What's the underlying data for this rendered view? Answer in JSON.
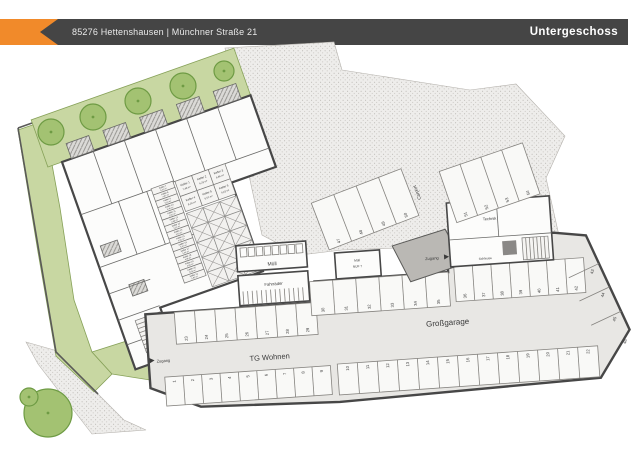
{
  "header": {
    "address": "85276 Hettenshausen | Münchner Straße 21",
    "title": "Untergeschoss"
  },
  "colors": {
    "bar": "#454545",
    "accent": "#f18a2a",
    "wall": "#474747",
    "green": "#c8d7a2",
    "tree": "#a3c272",
    "garage": "#e8e7e4"
  },
  "labels": {
    "tg_wohnen": "TG Wohnen",
    "grossgarage": "Großgarage",
    "muell": "Müll",
    "fahrraeder": "Fahrräder",
    "carport": "Carport",
    "technik": "Technik",
    "schleuse": "Schleuse",
    "zugang_tg": "Zugang",
    "zugang_technik": "Zugang",
    "muell_nuf_line1": "Müll",
    "muell_nuf_line2": "NUF 7"
  },
  "keller_top": [
    {
      "name": "Keller 1",
      "area": "7,49 m²"
    },
    {
      "name": "Keller 2",
      "area": "6,32 m²"
    },
    {
      "name": "Keller 3",
      "area": "6,86 m²"
    },
    {
      "name": "Keller 4",
      "area": "8,03 m²"
    },
    {
      "name": "Keller 5",
      "area": "6,51 m²"
    },
    {
      "name": "Keller 6",
      "area": "6,02 m²"
    }
  ],
  "keller_left": [
    {
      "name": "Keller 7",
      "area": "5,32 m²"
    },
    {
      "name": "Keller 8",
      "area": "4,97 m²"
    },
    {
      "name": "Keller 9",
      "area": "5,10 m²"
    },
    {
      "name": "Keller 10",
      "area": "5,48 m²"
    },
    {
      "name": "Keller 11",
      "area": "5,02 m²"
    },
    {
      "name": "Keller 12",
      "area": "4,86 m²"
    },
    {
      "name": "Keller 13",
      "area": "5,21 m²"
    },
    {
      "name": "Keller 14",
      "area": "5,63 m²"
    },
    {
      "name": "Keller 15",
      "area": "4,91 m²"
    },
    {
      "name": "Keller 16",
      "area": "5,07 m²"
    },
    {
      "name": "Keller 17",
      "area": "5,44 m²"
    },
    {
      "name": "Keller 18",
      "area": "4,98 m²"
    },
    {
      "name": "Keller 19",
      "area": "4,86 m²"
    },
    {
      "name": "Keller 20",
      "area": "6,05 m²"
    },
    {
      "name": "Keller 21",
      "area": "5,92 m²"
    }
  ],
  "parking": {
    "tg_bottom": [
      "1",
      "2",
      "3",
      "4",
      "5",
      "6",
      "7",
      "8",
      "9"
    ],
    "tg_top": [
      "23",
      "24",
      "25",
      "26",
      "27",
      "28",
      "29"
    ],
    "gross_bottom": [
      "10",
      "11",
      "12",
      "13",
      "14",
      "15",
      "16",
      "17",
      "18",
      "19",
      "20",
      "21",
      "22"
    ],
    "gross_top_left": [
      "30",
      "31",
      "32",
      "33",
      "34",
      "35"
    ],
    "gross_top_right": [
      "36",
      "37",
      "38",
      "39",
      "40",
      "41",
      "42"
    ],
    "right_slant": [
      "43",
      "44",
      "45",
      "46"
    ],
    "carport": [
      "47",
      "48",
      "49",
      "50"
    ],
    "upper_right": [
      "51",
      "52",
      "53",
      "54"
    ]
  }
}
